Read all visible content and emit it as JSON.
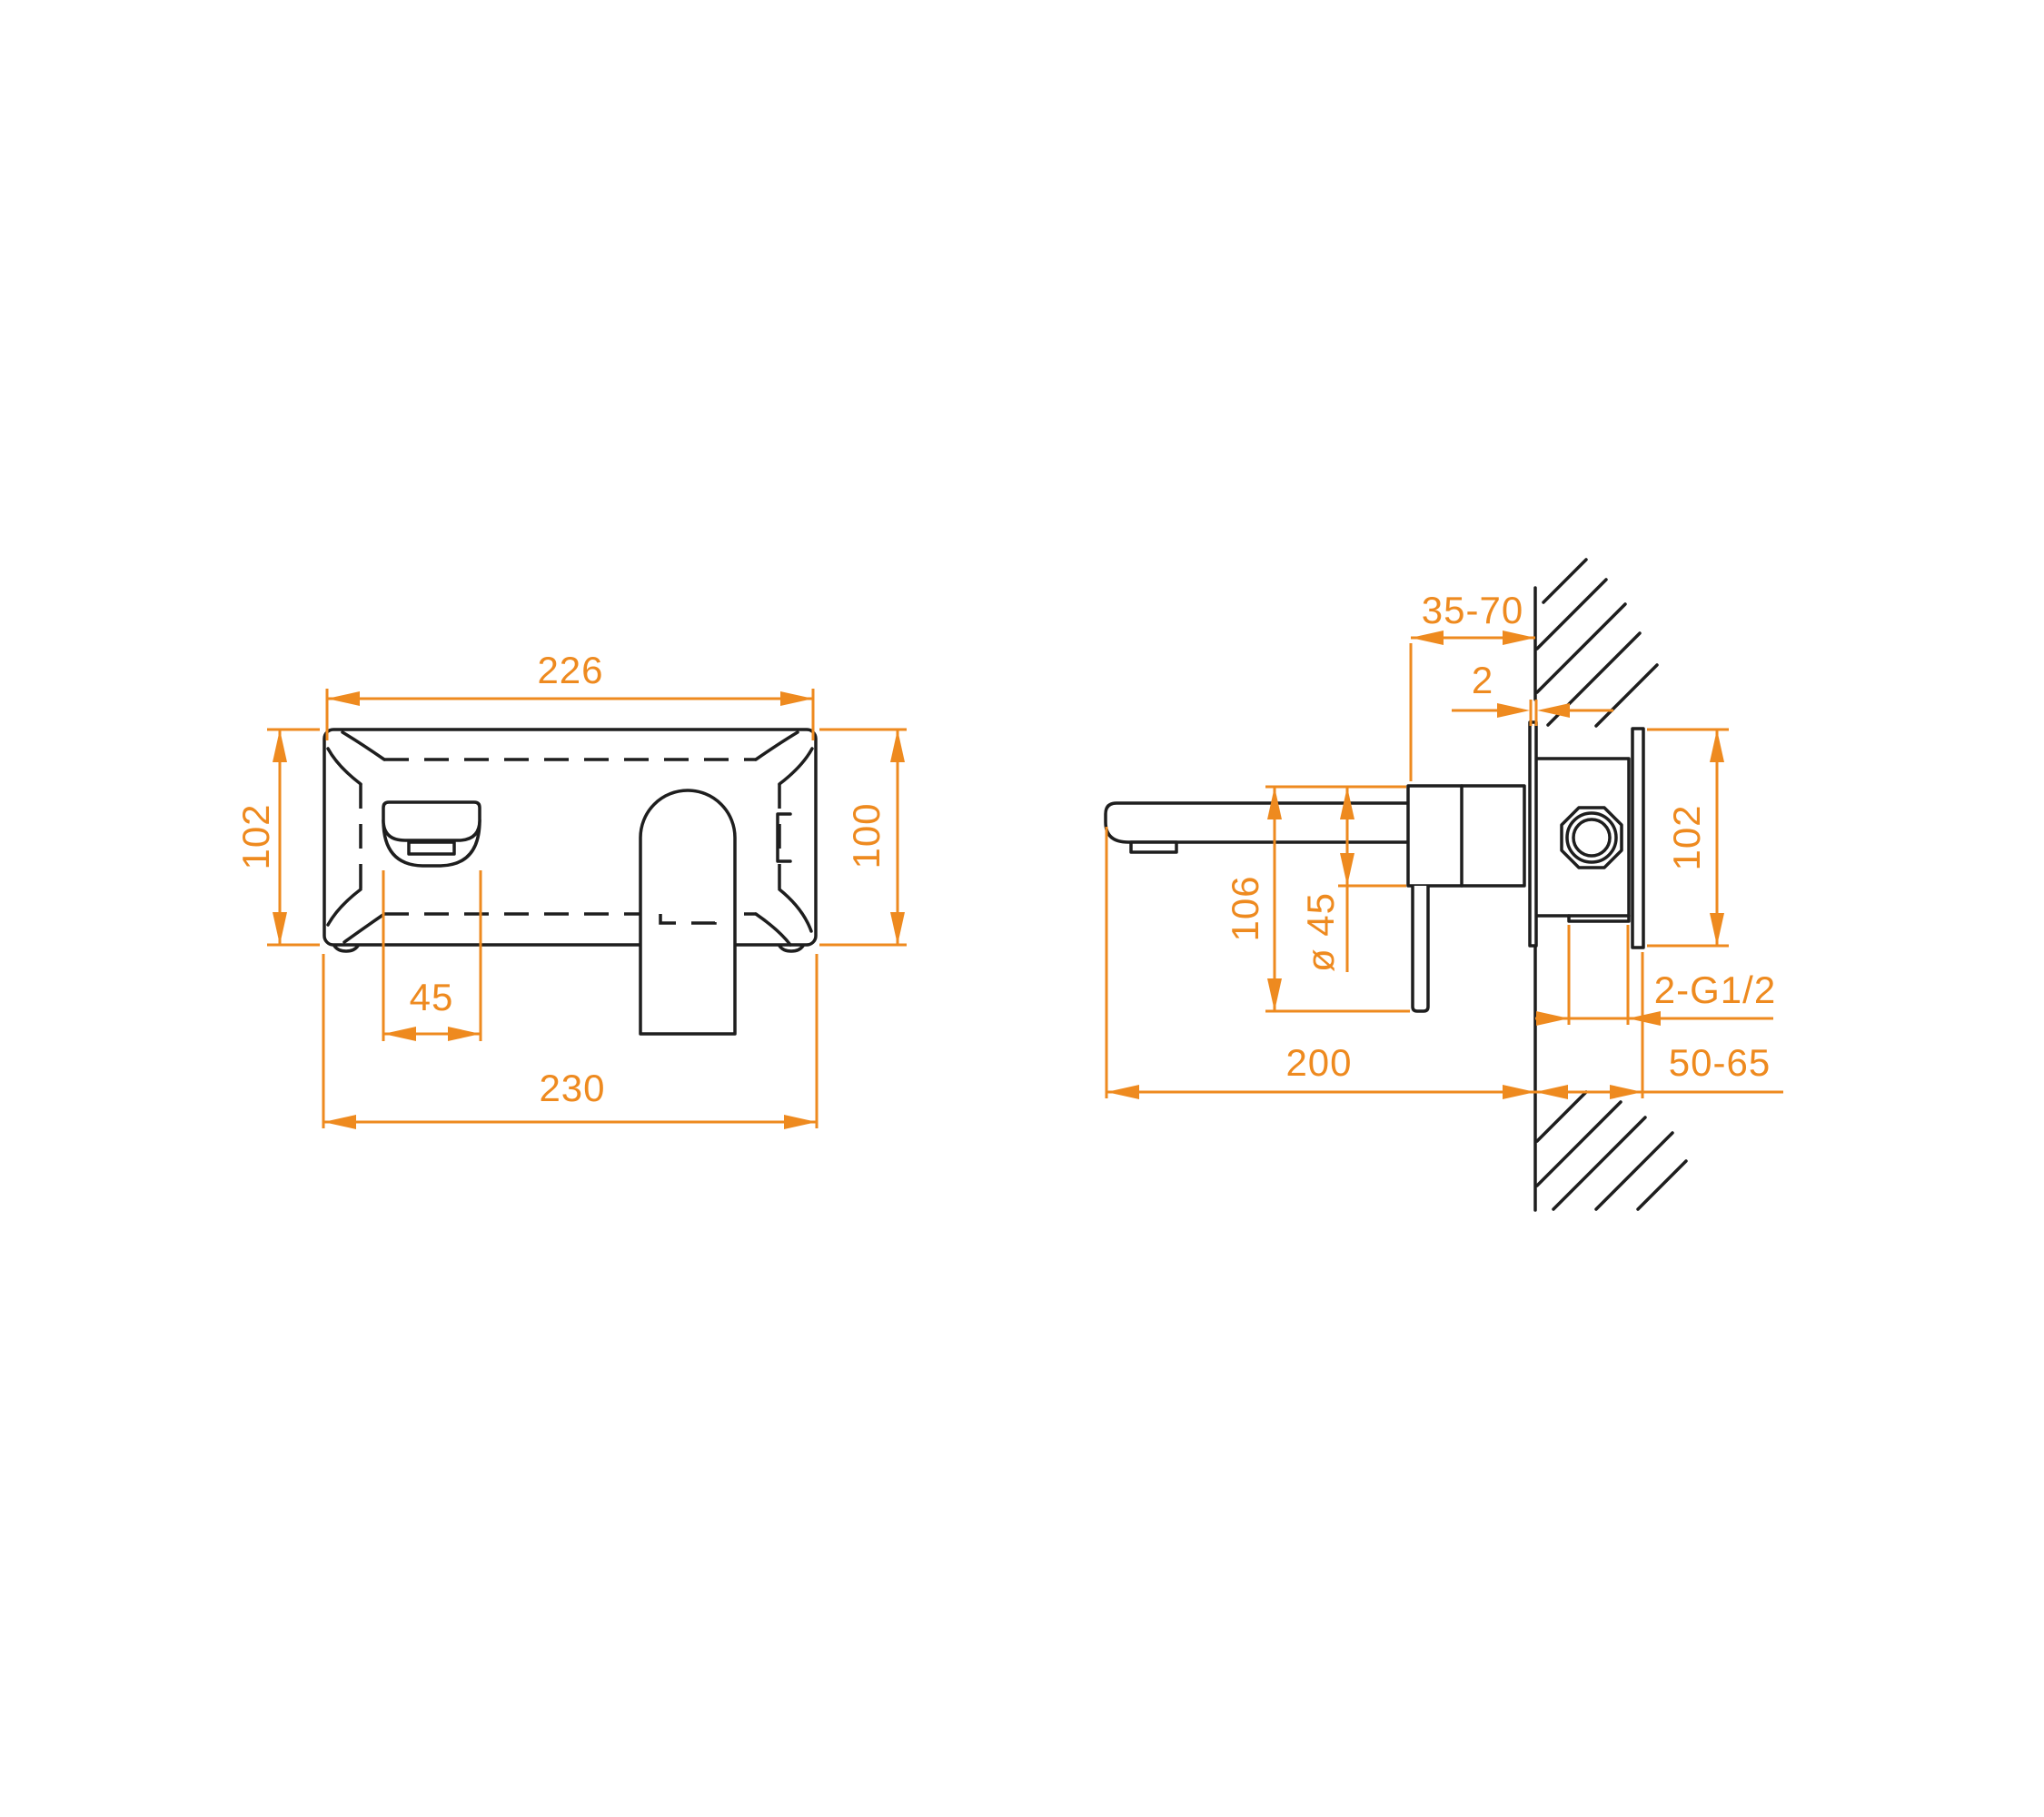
{
  "drawing": {
    "type": "technical-installation-drawing",
    "product": "wall-mounted-basin-mixer",
    "colors": {
      "dimension_accent": "#EE8A1F",
      "line": "#1E1E1E",
      "background": "#FFFFFF"
    },
    "front_view": {
      "dims": {
        "width_top": "226",
        "height_left": "102",
        "height_right": "100",
        "handle_width": "45",
        "width_bottom": "230"
      }
    },
    "side_view": {
      "dims": {
        "wall_depth_range": "35-70",
        "trim_plate_thickness": "2",
        "backplate_height": "102",
        "drop_height": "106",
        "body_diameter": "ø 45",
        "thread_callout": "2-G1/2",
        "spout_projection": "200",
        "embed_depth": "50-65"
      }
    }
  }
}
